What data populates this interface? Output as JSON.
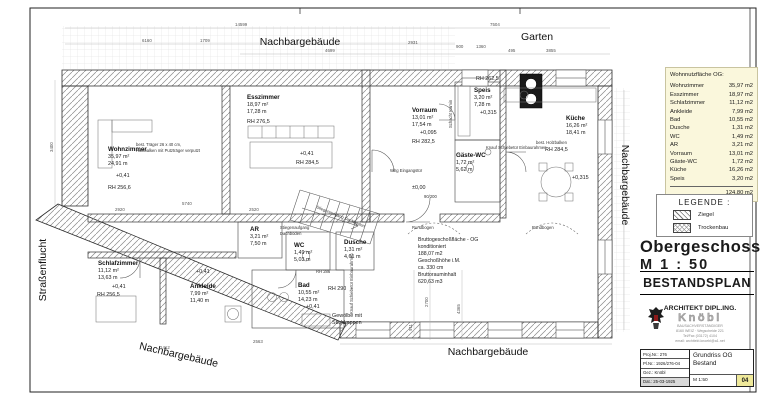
{
  "site": {
    "top_label": "Nachbargebäude",
    "garten": "Garten",
    "right_label": "Nachbargebäude",
    "bottom_left_label": "Nachbargebäude",
    "bottom_center_label": "Nachbargebäude",
    "street_label": "Straßenflucht"
  },
  "rooms": [
    {
      "name": "Wohnzimmer",
      "area": "35,97 m²",
      "perimeter": "24,91 m",
      "level": "+0,41",
      "rh": "RH 256,6"
    },
    {
      "name": "Esszimmer",
      "area": "18,97 m²",
      "perimeter": "17,28 m",
      "level": "",
      "rh": "RH 276,5"
    },
    {
      "name": "Schlafzimmer",
      "area": "11,12 m²",
      "perimeter": "13,63 m",
      "level": "+0,41",
      "rh": "RH 256,5"
    },
    {
      "name": "Ankleide",
      "area": "7,99 m²",
      "perimeter": "11,40 m",
      "level": "+0,41",
      "rh": ""
    },
    {
      "name": "AR",
      "area": "3,21 m²",
      "perimeter": "7,50 m",
      "level": "",
      "rh": ""
    },
    {
      "name": "WC",
      "area": "1,49 m²",
      "perimeter": "5,03 m",
      "level": "",
      "rh": ""
    },
    {
      "name": "Dusche",
      "area": "1,31 m²",
      "perimeter": "4,61 m",
      "level": "",
      "rh": ""
    },
    {
      "name": "Bad",
      "area": "10,55 m²",
      "perimeter": "14,23 m",
      "level": "+0,41",
      "rh": "RH 290"
    },
    {
      "name": "Vorraum",
      "area": "13,01 m²",
      "perimeter": "17,54 m",
      "level": "+0,095",
      "rh": "RH 282,5"
    },
    {
      "name": "Gäste-WC",
      "area": "1,72 m²",
      "perimeter": "5,62 m",
      "level": "",
      "rh": ""
    },
    {
      "name": "Küche",
      "area": "16,26 m²",
      "perimeter": "18,41 m",
      "level": "+0,315",
      "rh": "RH 284,5"
    },
    {
      "name": "Speis",
      "area": "3,20 m²",
      "perimeter": "7,28 m",
      "level": "+0,315",
      "rh": "RH 262,5"
    }
  ],
  "annotations": {
    "level_hall": "+0,41",
    "rh_hall": "RH 284,5",
    "traeger_line1": "best. Träger 26 x 40 cm,",
    "traeger_line2": "Holzbalken mit Putzträger verputzt",
    "stair_line1": "Stiegenaufgang",
    "stair_line2": "Dachboden",
    "stair_rot": "Stiegenaufgang Dachboden",
    "vault_line1": "Gewölbe mit",
    "vault_line2": "Stichkappen",
    "arch1": "Rundbogen",
    "arch2": "Rundbogen",
    "entry_door": "Whg Eingangstür",
    "level_zero": "±0,00",
    "rh_286": "RH 286",
    "chimney": "Schacht Kamin",
    "beam": "best. Holzbalken",
    "sliding_door": "Knauf Schiebetür Einbaurahmen",
    "door_size": "90/200"
  },
  "summary": {
    "lines": [
      "Bruttogeschoßfläche - OG",
      "konditioniert",
      "188,07 m2",
      "Geschoßhöhe i.M.",
      "ca. 330 cm",
      "Bruttorauminhalt",
      "620,63 m3"
    ]
  },
  "dims": [
    "6160",
    "1709",
    "14599",
    "4699",
    "2931",
    "900",
    "1360",
    "7504",
    "495",
    "3855",
    "2920",
    "5740",
    "2520",
    "2563",
    "1412",
    "4365",
    "2700",
    "911",
    "3400"
  ],
  "panel": {
    "area_table": {
      "title": "Wohnnutzfläche OG:",
      "rows": [
        [
          "Wohnzimmer",
          "35,97 m2"
        ],
        [
          "Esszimmer",
          "18,97 m2"
        ],
        [
          "Schlafzimmer",
          "11,12 m2"
        ],
        [
          "Ankleide",
          "7,99 m2"
        ],
        [
          "Bad",
          "10,55 m2"
        ],
        [
          "Dusche",
          "1,31 m2"
        ],
        [
          "WC",
          "1,49 m2"
        ],
        [
          "AR",
          "3,21 m2"
        ],
        [
          "Vorraum",
          "13,01 m2"
        ],
        [
          "Gäste-WC",
          "1,72 m2"
        ],
        [
          "Küche",
          "16,26 m2"
        ],
        [
          "Speis",
          "3,20 m2"
        ]
      ],
      "total": "124,80 m2"
    },
    "legend": {
      "title": "LEGENDE :",
      "items": [
        "Ziegel",
        "Trockenbau"
      ]
    },
    "plan_title": {
      "line1": "Obergeschoss",
      "line2": "M  1 : 50"
    },
    "stamp": "BESTANDSPLAN",
    "architect": {
      "line1": "ARCHITEKT DIPL.ING.",
      "logo": "Knöbl",
      "line3": "BAUSACHVERSTÄNDIGER",
      "line4": "8160 WEIZ · Wegscheide 221",
      "line5": "Tel/Fax (03172) 4104",
      "line6": "email: architekt.knoebl@a1.net"
    },
    "titleblock": {
      "proj": "Proj.Nr.: 276",
      "plnr": "Pl.Nr.: 1926/276-04",
      "gez": "Gez.: Knöbl",
      "dat": "Dat.: 25-03-1925",
      "drawing1": "Grundriss OG",
      "drawing2": "Bestand",
      "scale": "M 1:50",
      "sheet": "04"
    }
  },
  "colors": {
    "table_bg": "#faf7dc",
    "sheet_no_bg": "#efe99a",
    "highlight_row": "#d9d9d9",
    "hatch_line": "#8a8a8a"
  }
}
